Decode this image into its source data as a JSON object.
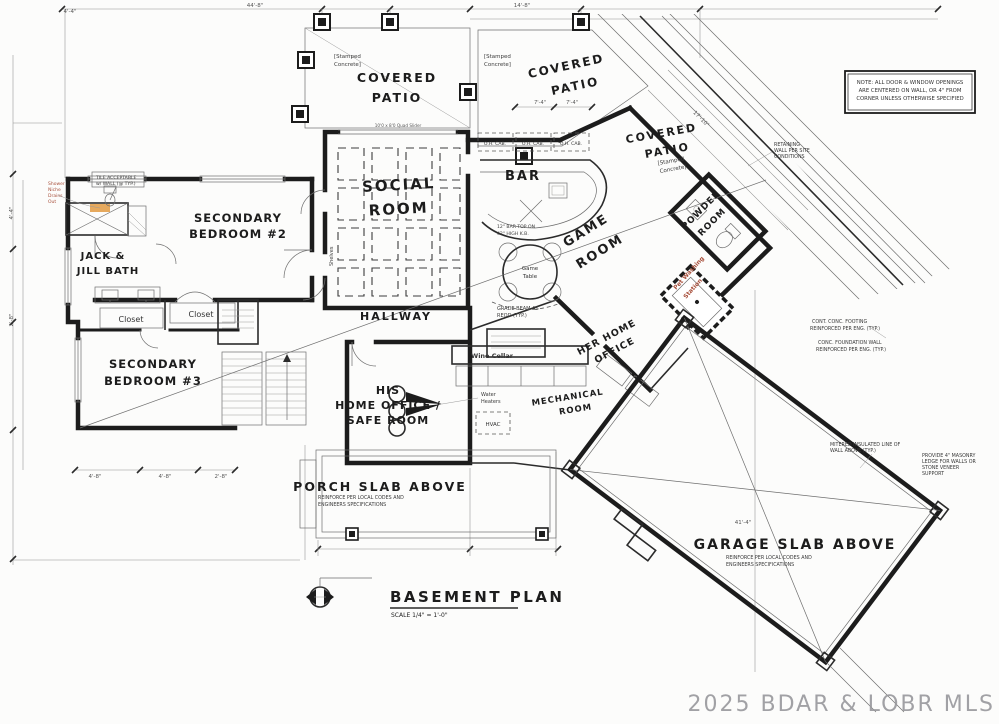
{
  "meta": {
    "watermark": "2025 BDAR & LOBR MLS"
  },
  "title_block": {
    "title": "BASEMENT PLAN",
    "scale": "SCALE 1/4\" = 1'-0\""
  },
  "note_box": {
    "line1": "NOTE: ALL DOOR & WINDOW OPENINGS",
    "line2": "ARE CENTERED ON WALL, OR 4\" FROM",
    "line3": "CORNER UNLESS OTHERWISE SPECIFIED"
  },
  "rooms": {
    "covered_patio": {
      "line1": "COVERED",
      "line2": "PATIO"
    },
    "stamped_concrete": {
      "line1": "[Stamped",
      "line2": "Concrete]"
    },
    "social_room": {
      "line1": "SOCIAL",
      "line2": "ROOM"
    },
    "bar": "BAR",
    "game_room": {
      "line1": "GAME",
      "line2": "ROOM"
    },
    "powder_room": {
      "line1": "POWDER",
      "line2": "ROOM"
    },
    "secondary_bedroom_2": {
      "line1": "SECONDARY",
      "line2": "BEDROOM #2"
    },
    "jack_jill_bath": {
      "line1": "JACK &",
      "line2": "JILL BATH"
    },
    "secondary_bedroom_3": {
      "line1": "SECONDARY",
      "line2": "BEDROOM #3"
    },
    "hallway": "HALLWAY",
    "his_office": {
      "line1": "HIS",
      "line2": "HOME OFFICE /",
      "line3": "SAFE ROOM"
    },
    "her_office": {
      "line1": "HER HOME",
      "line2": "OFFICE"
    },
    "mechanical": {
      "line1": "MECHANICAL",
      "line2": "ROOM"
    },
    "wine_cellar": "Wine Cellar",
    "closet": "Closet",
    "game_table": {
      "line1": "Game",
      "line2": "Table"
    },
    "porch_slab": "PORCH SLAB ABOVE",
    "garage_slab": "GARAGE SLAB ABOVE",
    "pet_wash": {
      "line1": "Pet Washing",
      "line2": "Station"
    },
    "shelves": "Shelves"
  },
  "notes": {
    "reinforce": {
      "line1": "REINFORCE PER LOCAL CODES AND",
      "line2": "ENGINEERS SPECIFICATIONS"
    },
    "retaining": {
      "line1": "RETAINING",
      "line2": "WALL PER SITE",
      "line3": "CONDITIONS"
    },
    "footing": {
      "line1": "CONT. CONC. FOOTING",
      "line2": "REINFORCED PER ENG. (TYP.)"
    },
    "foundation": {
      "line1": "CONC. FOUNDATION WALL",
      "line2": "REINFORCED PER ENG. (TYP.)"
    },
    "mitered": {
      "line1": "MITERED INSULATED LINE OF",
      "line2": "WALL ABOVE (TYP.)"
    },
    "masonry": {
      "line1": "PROVIDE 4\" MASONRY",
      "line2": "LEDGE FOR WALLS OR",
      "line3": "STONE VENEER",
      "line4": "SUPPORT"
    },
    "grade_beam": {
      "line1": "GRADE BEAM AS",
      "line2": "REQD (TYP.)"
    },
    "water_heaters": {
      "line1": "Water",
      "line2": "Heaters"
    },
    "hvac": "HVAC",
    "bar_top": {
      "line1": "12\" BAR TOP ON",
      "line2": "42\" HIGH K.B."
    },
    "oh_cab": "O.H. CAB.",
    "quad_slider": "10'0 x 8'0 Quad Slider",
    "tile": {
      "line1": "TILE ACCEPTABLE",
      "line2": "w/ WALL (@ TYP.)"
    },
    "shower": {
      "line1": "Shower",
      "line2": "Niche",
      "line3": "Drains",
      "line4": "Out"
    }
  },
  "dims": {
    "top_left": "4'-4\"",
    "top_main": "44'-8\"",
    "top_mid": "14'-8\"",
    "patio_total": "17'-10\"",
    "patio_a": "7'-4\"",
    "patio_b": "7'-4\"",
    "bed3_a": "4'-8\"",
    "bed3_b": "4'-8\"",
    "bed3_c": "2'-8\"",
    "left_a": "4'-4\"",
    "left_b": "2'-8\"",
    "garage": "41'-4\""
  },
  "colors": {
    "wall": "#1c1c1c",
    "thin_line": "#6e6e6e",
    "red_note": "#a8503c",
    "highlight": "#e3a04b",
    "watermark": "#98989c",
    "paper": "#fcfcfb"
  }
}
